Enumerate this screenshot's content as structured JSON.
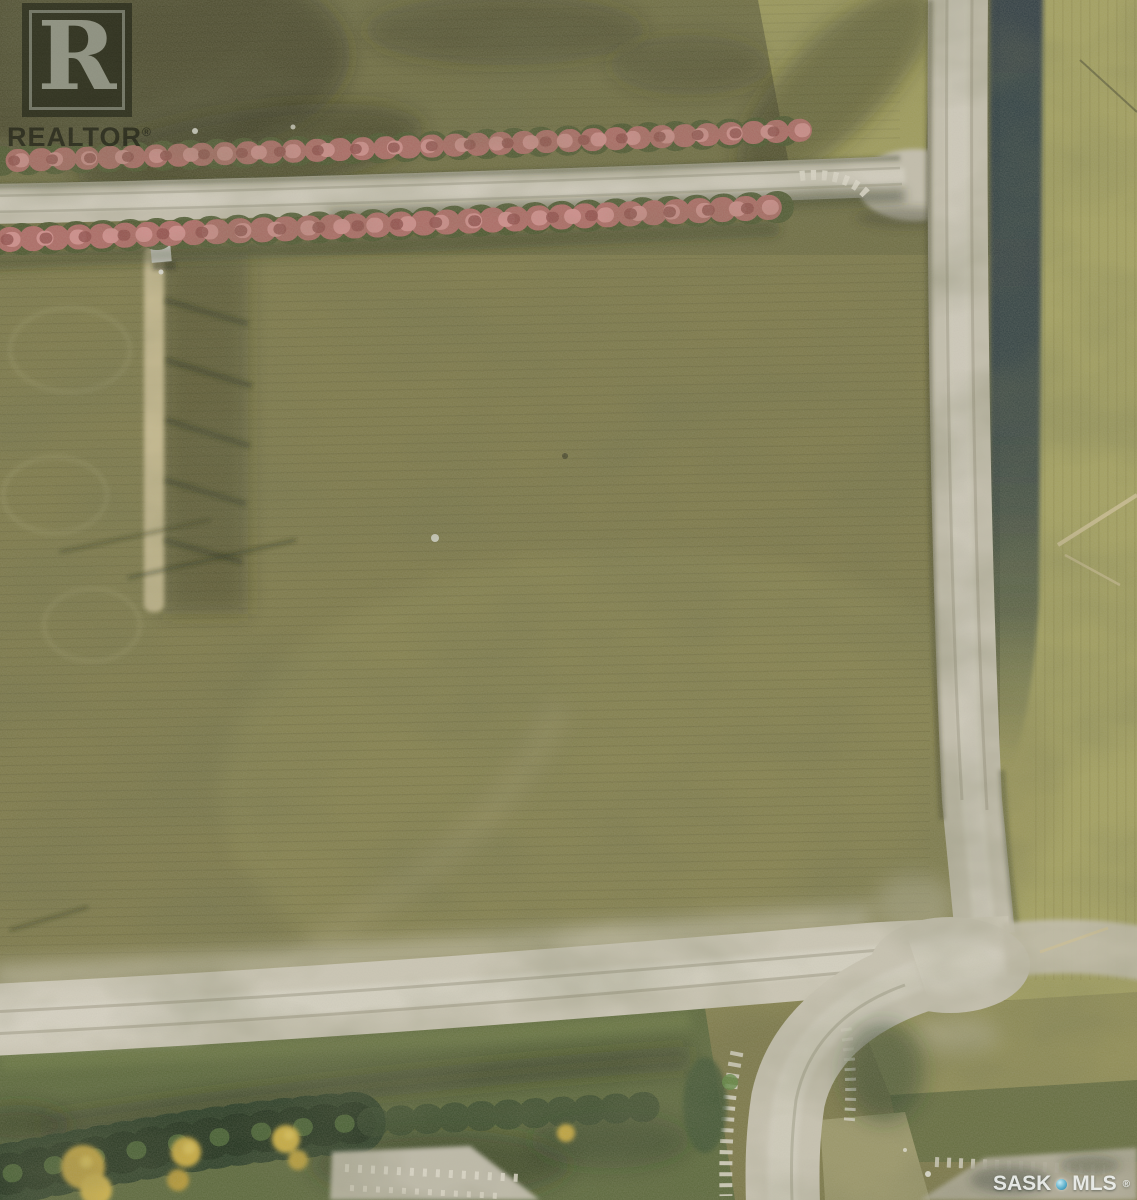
{
  "watermarks": {
    "realtor": {
      "letter": "R",
      "wordmark": "REALTOR",
      "registered": "®"
    },
    "mls": {
      "prefix": "SASK",
      "suffix": "MLS",
      "registered": "®"
    }
  },
  "icons": {
    "mls_separator": "sphere-dot-icon"
  },
  "scene": {
    "colors": {
      "field_olive": "#7c7848",
      "field_top_strip": "#6e6c41",
      "grass_light_right": "#a3a05f",
      "grass_light_top_right": "#9d9a5a",
      "road_gravel": "#c4bfae",
      "road_highlight": "#d7d3c5",
      "road_dust": "#bcb79e",
      "ditch_dark": "#2c3a42",
      "shelterbelt_red": "#b26b68",
      "shelterbelt_pink": "#d2908e",
      "shelterbelt_deep_red": "#8e4b49",
      "shelterbelt_base_green": "#49552e",
      "hedgerow_pale": "#c9bc92",
      "verge_green": "#5a673a",
      "bottom_tree_dark": "#273a24",
      "bottom_tree_gold": "#caa83c",
      "gravel_patch": "#c5c0b0",
      "logo_overlay": "rgba(22,25,16,0.52)",
      "watermark_text": "rgba(246,248,246,0.88)"
    }
  }
}
